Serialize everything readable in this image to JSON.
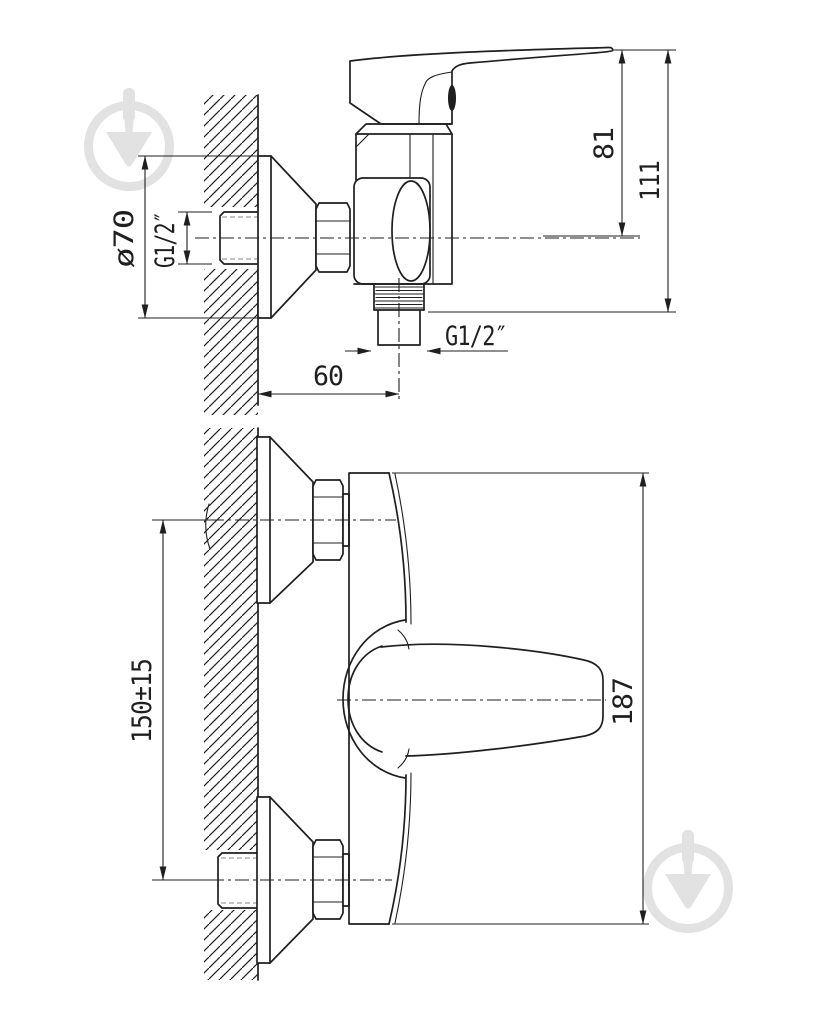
{
  "colors": {
    "line": "#1f1f1f",
    "background": "#ffffff",
    "watermark": "#e2e2e2"
  },
  "watermark": {
    "icon": "trowel-in-circle"
  },
  "dimensions": {
    "d81": "81",
    "d111": "111",
    "d70": "ø70",
    "g12_wall": "G1/2″",
    "g12_outlet": "G1/2″",
    "d60": "60",
    "d150": "150±15",
    "d187": "187"
  }
}
